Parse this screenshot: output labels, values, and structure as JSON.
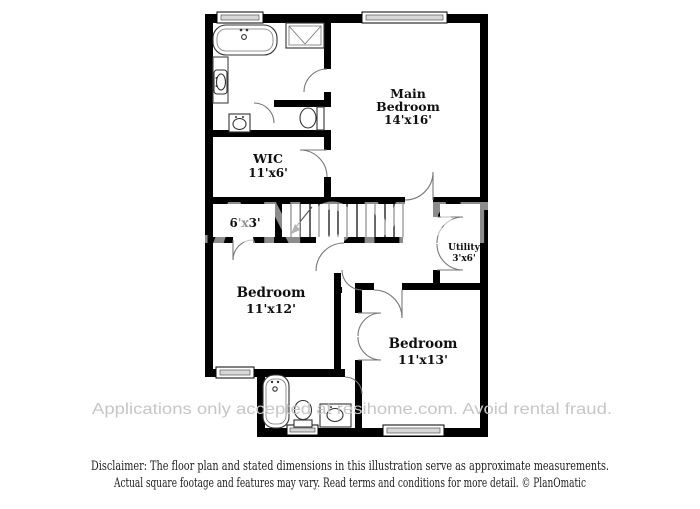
{
  "watermarks": {
    "center": "PLANOMATIC",
    "bottom": "Applications only accepted at resihome.com. Avoid rental fraud."
  },
  "rooms": {
    "main_bedroom": {
      "line1": "Main",
      "line2": "Bedroom",
      "dims": "14'x16'"
    },
    "wic": {
      "name": "WIC",
      "dims": "11'x6'"
    },
    "closet": {
      "dims": "6'x3'"
    },
    "utility": {
      "name": "Utility",
      "dims": "3'x6'"
    },
    "bedroom_left": {
      "name": "Bedroom",
      "dims": "11'x12'"
    },
    "bedroom_right": {
      "name": "Bedroom",
      "dims": "11'x13'"
    }
  },
  "disclaimer": {
    "line1": "Disclaimer: The floor plan and stated dimensions in this illustration serve as approximate measurements.",
    "line2": "Actual square footage and features may vary. Read terms and conditions for more detail. © PlanOmatic"
  },
  "colors": {
    "wall": "#000000",
    "background": "#ffffff",
    "watermark_gray": "#c6c6c6"
  }
}
